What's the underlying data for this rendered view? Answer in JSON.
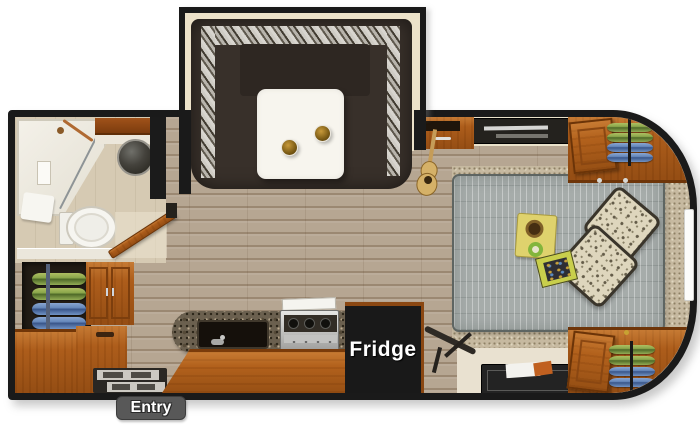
{
  "labels": {
    "fridge": "Fridge",
    "entry": "Entry"
  },
  "colors": {
    "wall": "#1a1a1a",
    "floor_wood": "#b6a692",
    "bathroom_floor": "#d6cab3",
    "cabinet_wood": "#ad5d1b",
    "dinette_sofa": "#38302a",
    "dinette_table": "#f7f5ee",
    "counter_granite": "#6b604f",
    "mattress_gray": "#a6acaa",
    "carpet": "#c6b9a0",
    "pillow": "#ded6bd",
    "clothes_green": "#8aa64b",
    "clothes_blue": "#6587ba",
    "fridge_box": "#191919",
    "entry_badge": "#585858",
    "label_text": "#ffffff"
  },
  "rooms": [
    "bathroom",
    "kitchen",
    "dinette-slideout",
    "bedroom",
    "entry"
  ],
  "furniture": [
    "u-dinette-slideout",
    "dinette-table",
    "cup-holders",
    "shower",
    "shower-niche",
    "bathroom-vanity",
    "round-vessel-sink",
    "toilet",
    "bathroom-door",
    "hanging-clothes-wardrobe-rear",
    "storage-bench",
    "overhead-cabinet",
    "entry-steps",
    "kitchen-counter",
    "kitchen-sink",
    "range-stove",
    "refrigerator",
    "folding-stand",
    "storage-tray",
    "bed",
    "pillows",
    "breakfast-tray",
    "book",
    "nightstand",
    "guitar",
    "tv",
    "hanging-clothes-wardrobe-front-top",
    "hanging-clothes-wardrobe-front-bottom",
    "window"
  ]
}
